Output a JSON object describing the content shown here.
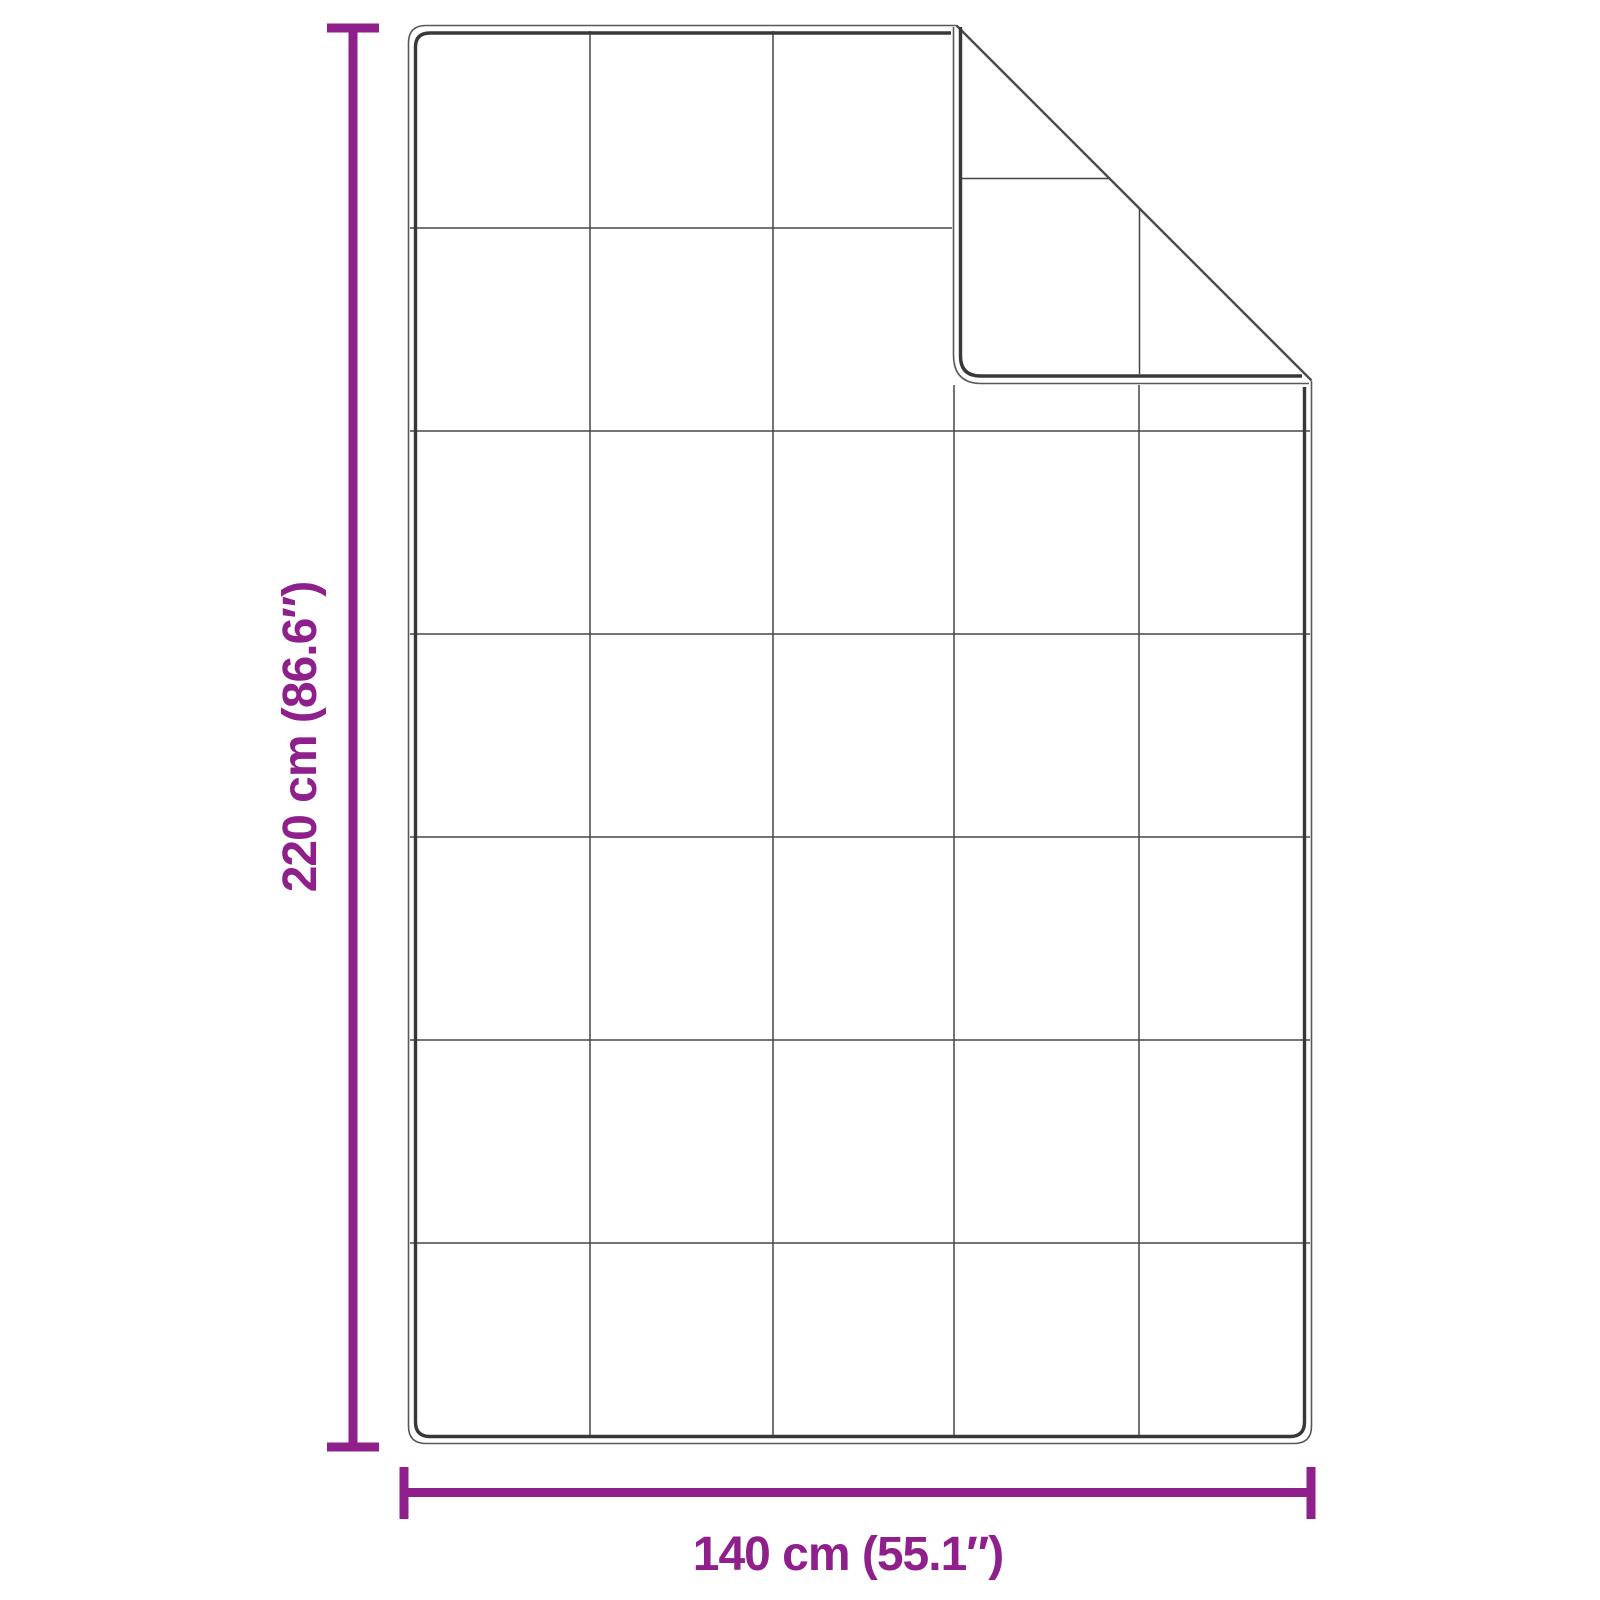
{
  "diagram": {
    "kind": "blanket-dimension-diagram",
    "height_label": "220 cm (86.6″)",
    "width_label": "140 cm (55.1″)",
    "grid": {
      "columns": 5,
      "rows": 7
    },
    "colors": {
      "dimension_accent": "#8E1F8B",
      "outline": "#585858",
      "stitch_border": "#383838",
      "grid_line": "#464646",
      "background": "#FFFFFF"
    }
  }
}
